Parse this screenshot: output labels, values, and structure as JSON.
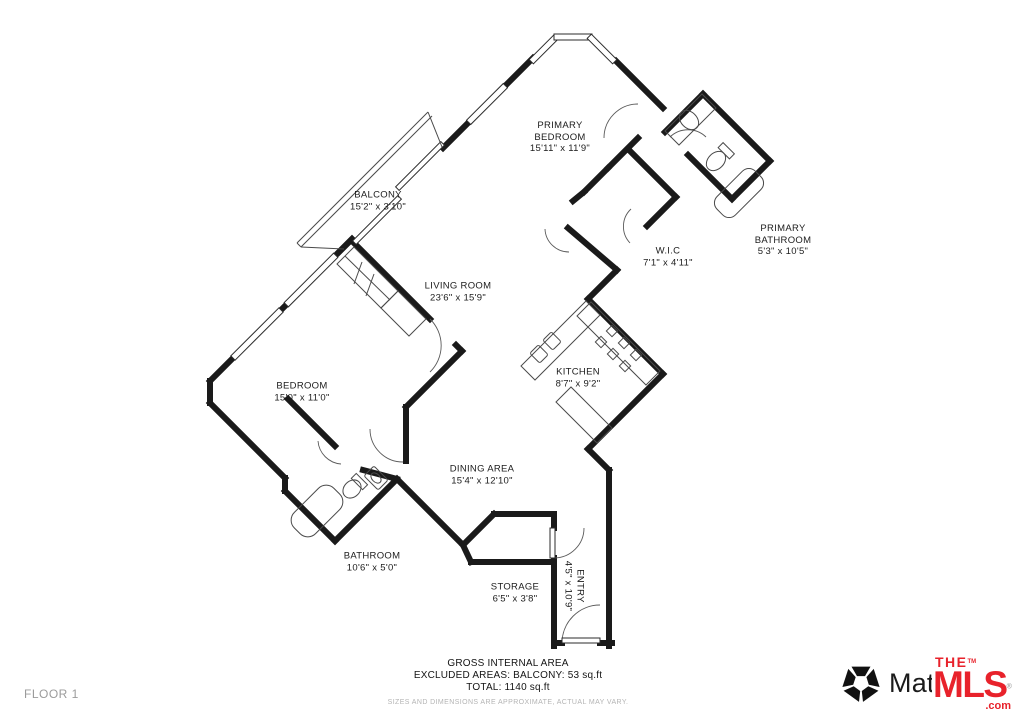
{
  "page": {
    "floor_label": "FLOOR 1"
  },
  "rooms": [
    {
      "id": "primary-bedroom",
      "name1": "PRIMARY",
      "name2": "BEDROOM",
      "dims": "15'11\" x 11'9\""
    },
    {
      "id": "balcony",
      "name1": "BALCONY",
      "name2": "",
      "dims": "15'2\" x 3'10\""
    },
    {
      "id": "primary-bathroom",
      "name1": "PRIMARY",
      "name2": "BATHROOM",
      "dims": "5'3\" x 10'5\""
    },
    {
      "id": "wic",
      "name1": "W.I.C",
      "name2": "",
      "dims": "7'1\" x 4'11\""
    },
    {
      "id": "living-room",
      "name1": "LIVING ROOM",
      "name2": "",
      "dims": "23'6\" x 15'9\""
    },
    {
      "id": "bedroom",
      "name1": "BEDROOM",
      "name2": "",
      "dims": "15'0\" x 11'0\""
    },
    {
      "id": "kitchen",
      "name1": "KITCHEN",
      "name2": "",
      "dims": "8'7\" x 9'2\""
    },
    {
      "id": "dining-area",
      "name1": "DINING AREA",
      "name2": "",
      "dims": "15'4\" x 12'10\""
    },
    {
      "id": "bathroom",
      "name1": "BATHROOM",
      "name2": "",
      "dims": "10'6\" x 5'0\""
    },
    {
      "id": "storage",
      "name1": "STORAGE",
      "name2": "",
      "dims": "6'5\" x 3'8\""
    },
    {
      "id": "entry",
      "name1": "ENTRY",
      "name2": "",
      "dims": "4'5\" x 10'9\""
    }
  ],
  "footer": {
    "line1": "GROSS INTERNAL AREA",
    "line2": "EXCLUDED AREAS: BALCONY: 53 sq.ft",
    "line3": "TOTAL: 1140 sq.ft",
    "disclaimer": "SIZES AND DIMENSIONS ARE APPROXIMATE, ACTUAL MAY VARY."
  },
  "branding": {
    "matterport": "Matterport",
    "mls_the": "THE",
    "mls_word": "MLS",
    "mls_com": ".com",
    "tm": "TM",
    "reg": "®"
  },
  "colors": {
    "wall": "#1a1a1a",
    "thin": "#3c3c3c",
    "mls_red": "#e8222b",
    "muted": "#9b9b9b"
  }
}
